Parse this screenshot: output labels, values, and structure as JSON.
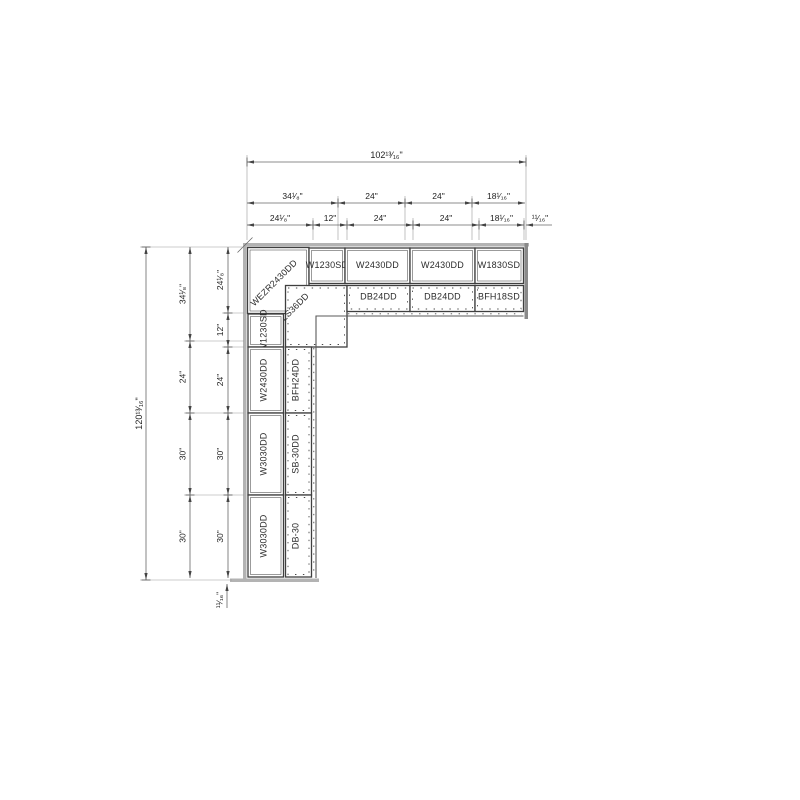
{
  "drawing": {
    "type": "kitchen-cabinet-plan",
    "colors": {
      "wall_gray": "#b3b3b3",
      "wall_dark": "#8a8a8a",
      "cabinet_line": "#3f3f3f",
      "dimension_line": "#666666",
      "background": "#ffffff"
    }
  },
  "dims": {
    "top_total": "102¹³⁄₁₆\"",
    "top_row2": [
      "34¹⁄₈\"",
      "24\"",
      "24\"",
      "18¹⁄₁₆\""
    ],
    "top_row3": [
      "24¹⁄₈\"",
      "12\"",
      "24\"",
      "24\"",
      "18¹⁄₁₆\"",
      "¹¹⁄₁₆\""
    ],
    "left_total": "120¹³⁄₁₆\"",
    "left_col2": [
      "34¹⁄₈\"",
      "24\"",
      "30\"",
      "30\""
    ],
    "left_col3": [
      "24¹⁄₈\"",
      "12\"",
      "24\"",
      "30\"",
      "30\""
    ],
    "left_bottom_gap": "¹¹⁄₁₆\""
  },
  "cabinets": {
    "top_wall": [
      "WEZR2430DD",
      "W1230SD",
      "W2430DD",
      "W2430DD",
      "W1830SD"
    ],
    "top_base": [
      "DB24DD",
      "DB24DD",
      "BFH18SD"
    ],
    "corner_base": "LS36DD",
    "left_wall": [
      "W1230SD",
      "W2430DD",
      "W3030DD",
      "W3030DD"
    ],
    "left_base": [
      "BFH24DD",
      "SB-30DD",
      "DB-30"
    ]
  }
}
